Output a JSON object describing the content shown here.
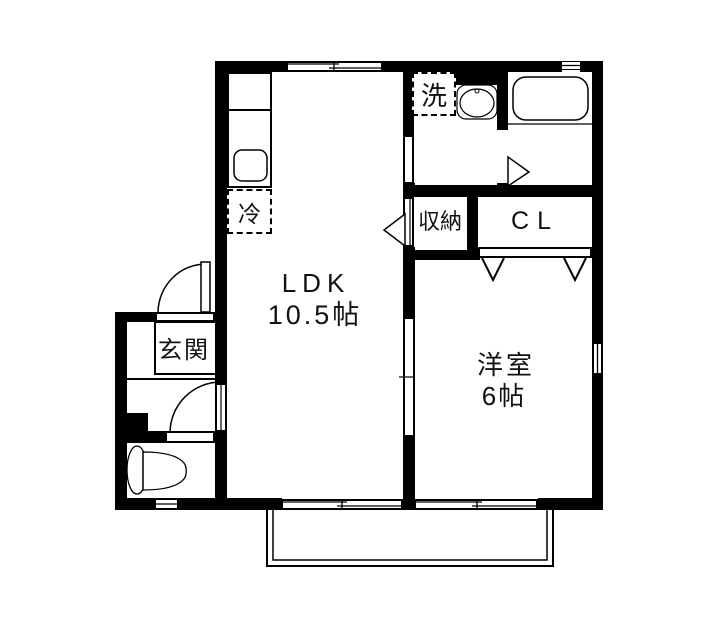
{
  "plan": {
    "labels": {
      "ldk_name": "LDK",
      "ldk_size": "10.5帖",
      "western_name": "洋室",
      "western_size": "6帖",
      "entrance": "玄関",
      "storage": "収納",
      "closet": "CL",
      "washer": "洗",
      "fridge": "冷"
    },
    "colors": {
      "wall": "#000000",
      "background": "#ffffff"
    }
  }
}
